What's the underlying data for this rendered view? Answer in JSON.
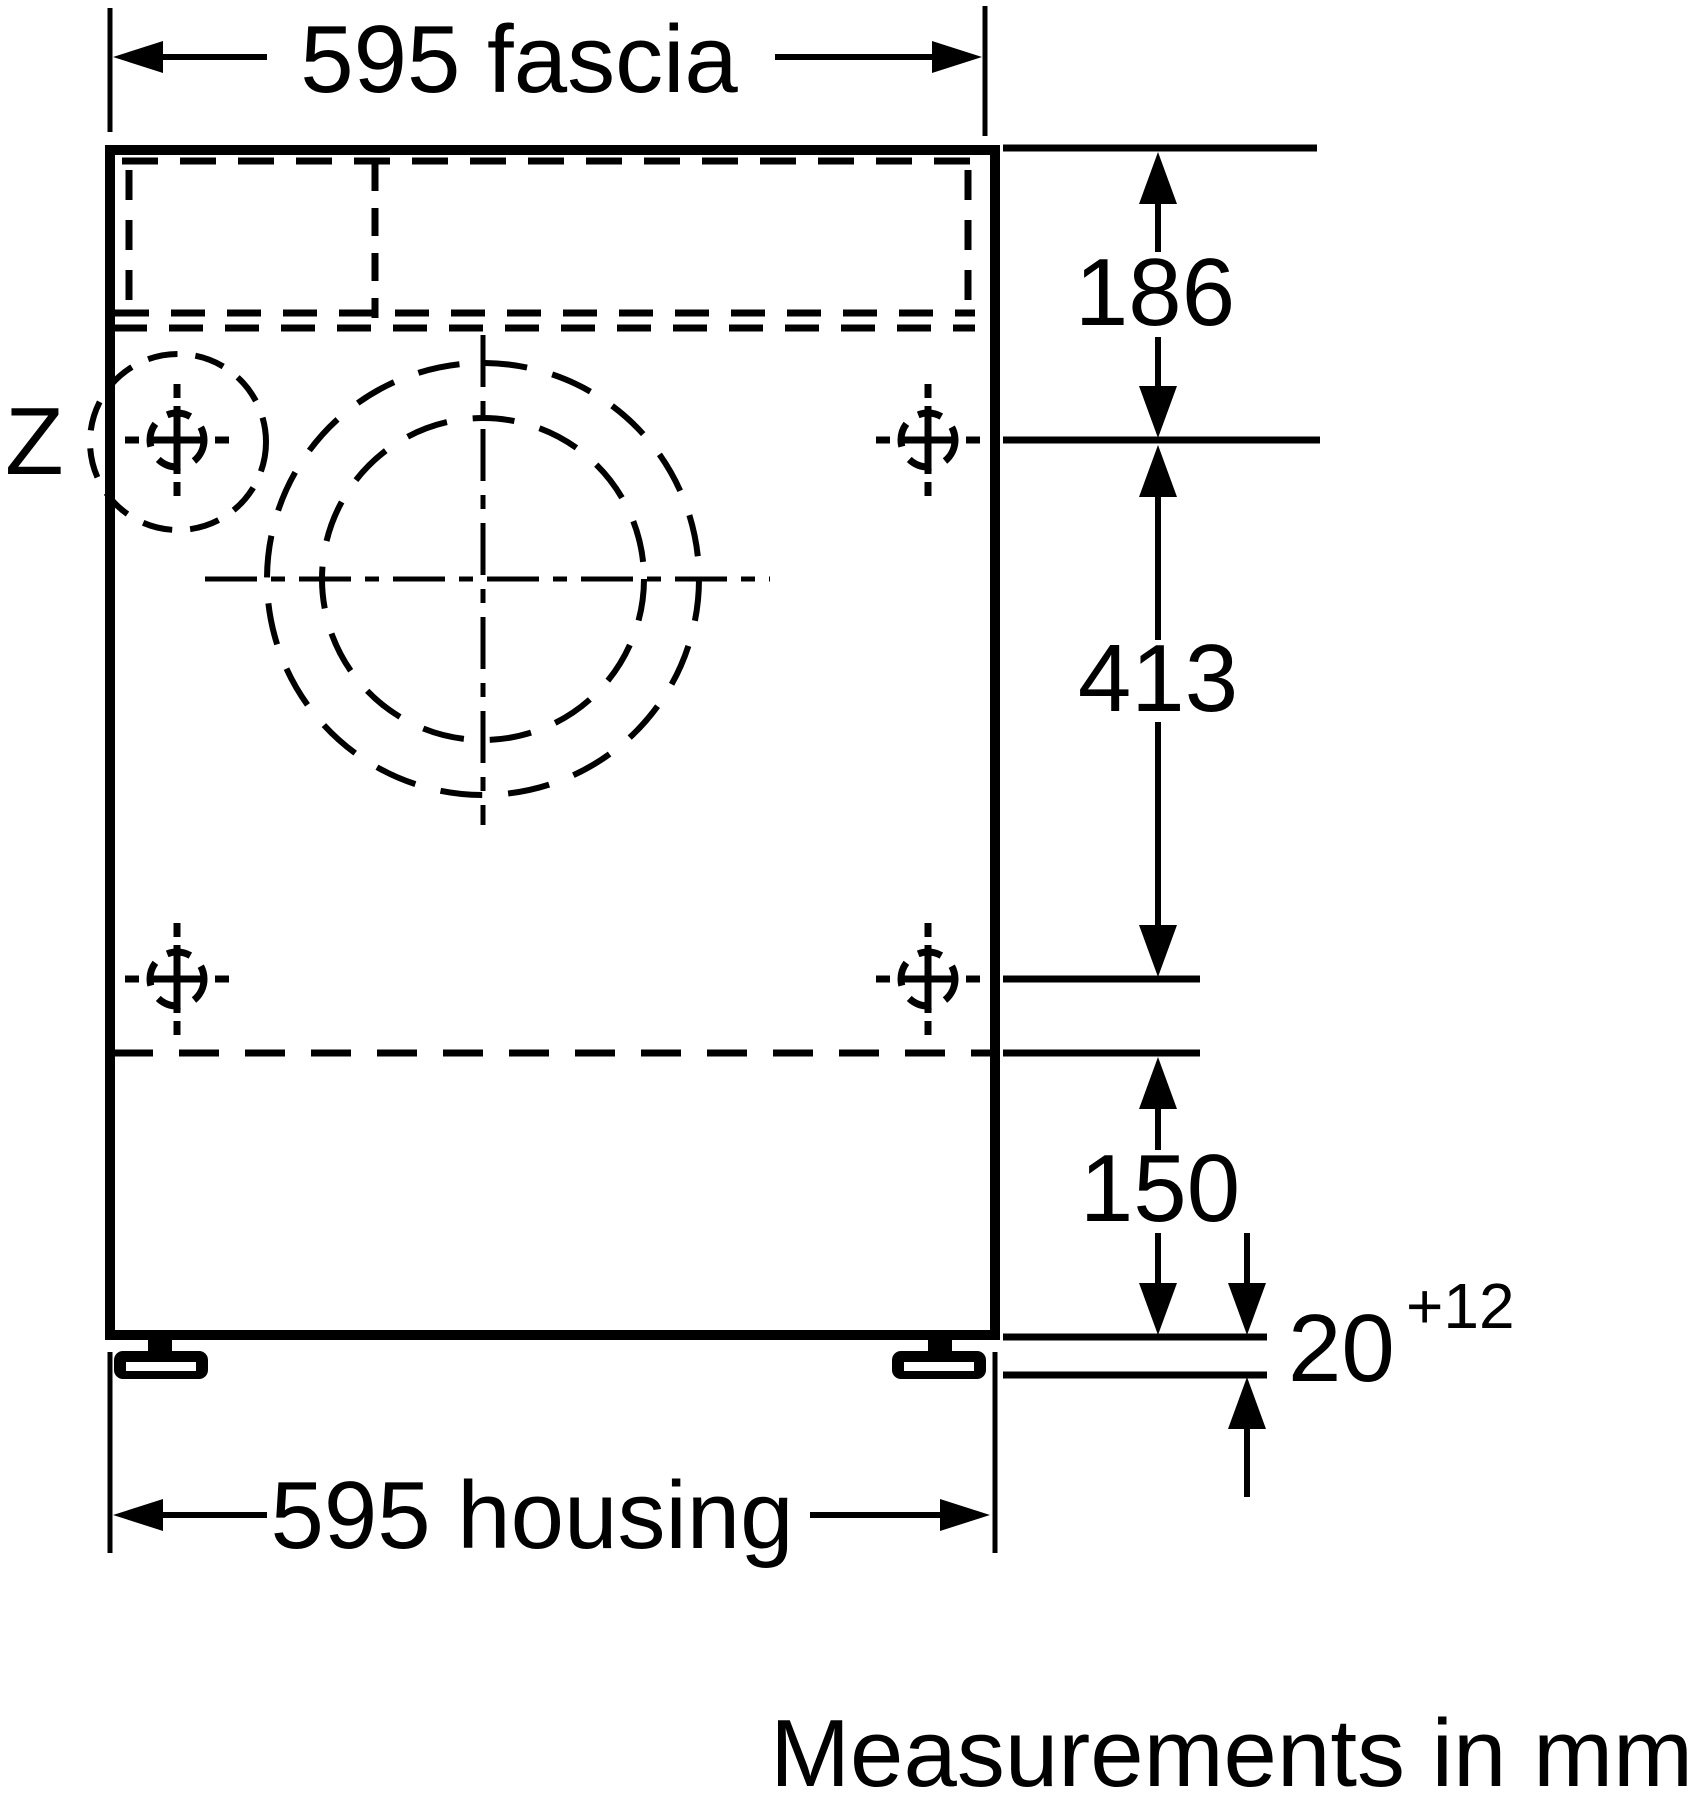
{
  "diagram": {
    "detail_marker": "Z",
    "dim_fascia": "595 fascia",
    "dim_top_offset": "186",
    "dim_screw_span": "413",
    "dim_plinth": "150",
    "dim_foot_gap": "20",
    "dim_foot_gap_tolerance": "+12",
    "dim_housing": "595 housing",
    "footer_note": "Measurements in mm",
    "colors": {
      "line": "#000000",
      "background": "#ffffff"
    }
  }
}
